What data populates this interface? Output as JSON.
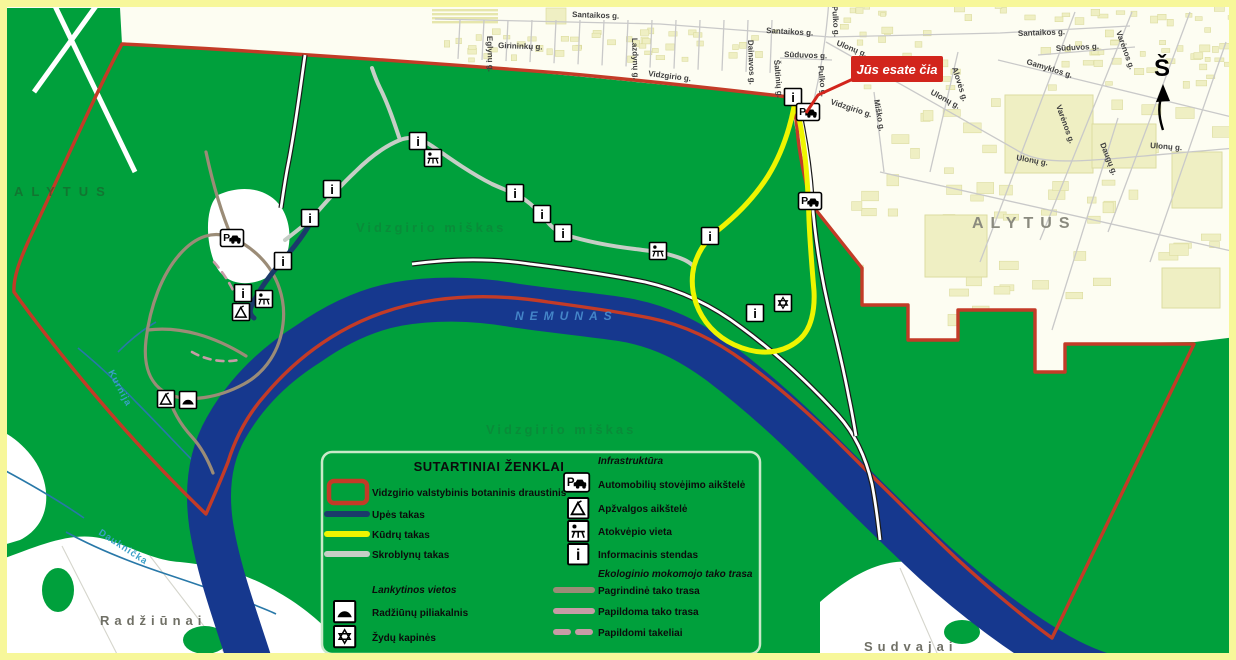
{
  "colors": {
    "forest": "#00A03C",
    "river": "#16388E",
    "boundary": "#C33B27",
    "urban": "#FDFDF2",
    "building": "#EFEFC3",
    "building_edge": "#DCDCA0",
    "trail_yellow": "#EEF500",
    "trail_river": "#1B3A6B",
    "trail_hornbeam": "#C6CEC6",
    "trail_main": "#9B8C77",
    "trail_extra": "#C79CA6",
    "you_are_here": "#D2251C",
    "frame": "#F7F79A"
  },
  "icons": {
    "parking": "P",
    "info": "i"
  },
  "you_are_here": {
    "label": "Jūs esate čia"
  },
  "compass": {
    "label": "Š"
  },
  "places": {
    "city": "ALYTUS",
    "city_west": "ALYTUS",
    "village_sw": "Radžiūnai",
    "village_se": "Sudvajai",
    "river": "NEMUNAS",
    "forest_a": "Vidzgirio miškas",
    "forest_b": "Vidzgirio miškas",
    "creek_n": "Kurnija",
    "creek_s": "Dauknička"
  },
  "streets": [
    {
      "name": "Santaikos g."
    },
    {
      "name": "Santaikos g."
    },
    {
      "name": "Santaikos g."
    },
    {
      "name": "Girininkų g."
    },
    {
      "name": "Eglynų g."
    },
    {
      "name": "Lazdynų g."
    },
    {
      "name": "Dainavos g."
    },
    {
      "name": "Šaltinių g."
    },
    {
      "name": "Sūduvos g."
    },
    {
      "name": "Sūduvos g."
    },
    {
      "name": "Pulko g."
    },
    {
      "name": "Pulko g."
    },
    {
      "name": "Vidzgirio g."
    },
    {
      "name": "Vidzgirio g."
    },
    {
      "name": "Miško g."
    },
    {
      "name": "Ulonų g."
    },
    {
      "name": "Ulonų g."
    },
    {
      "name": "Ulonų g."
    },
    {
      "name": "Ulonų g."
    },
    {
      "name": "Alovės g."
    },
    {
      "name": "Gamyklos g."
    },
    {
      "name": "Varėnos g."
    },
    {
      "name": "Varėnos g."
    },
    {
      "name": "Daugų g."
    }
  ],
  "legend": {
    "title": "SUTARTINIAI ŽENKLAI",
    "areas": [
      {
        "label": "Vidzgirio valstybinis botaninis draustinis"
      },
      {
        "label": "Upės takas"
      },
      {
        "label": "Kūdrų takas"
      },
      {
        "label": "Skroblynų takas"
      }
    ],
    "visit_header": "Lankytinos vietos",
    "visit": [
      {
        "label": "Radžiūnų piliakalnis"
      },
      {
        "label": "Žydų kapinės"
      }
    ],
    "infra_header": "Infrastruktūra",
    "infra": [
      {
        "label": "Automobilių stovėjimo aikštelė"
      },
      {
        "label": "Apžvalgos aikštelė"
      },
      {
        "label": "Atokvėpio vieta"
      },
      {
        "label": "Informacinis stendas"
      }
    ],
    "eco_header": "Ekologinio mokomojo tako trasa",
    "eco": [
      {
        "label": "Pagrindinė tako trasa"
      },
      {
        "label": "Papildoma tako trasa"
      },
      {
        "label": "Papildomi takeliai"
      }
    ]
  }
}
